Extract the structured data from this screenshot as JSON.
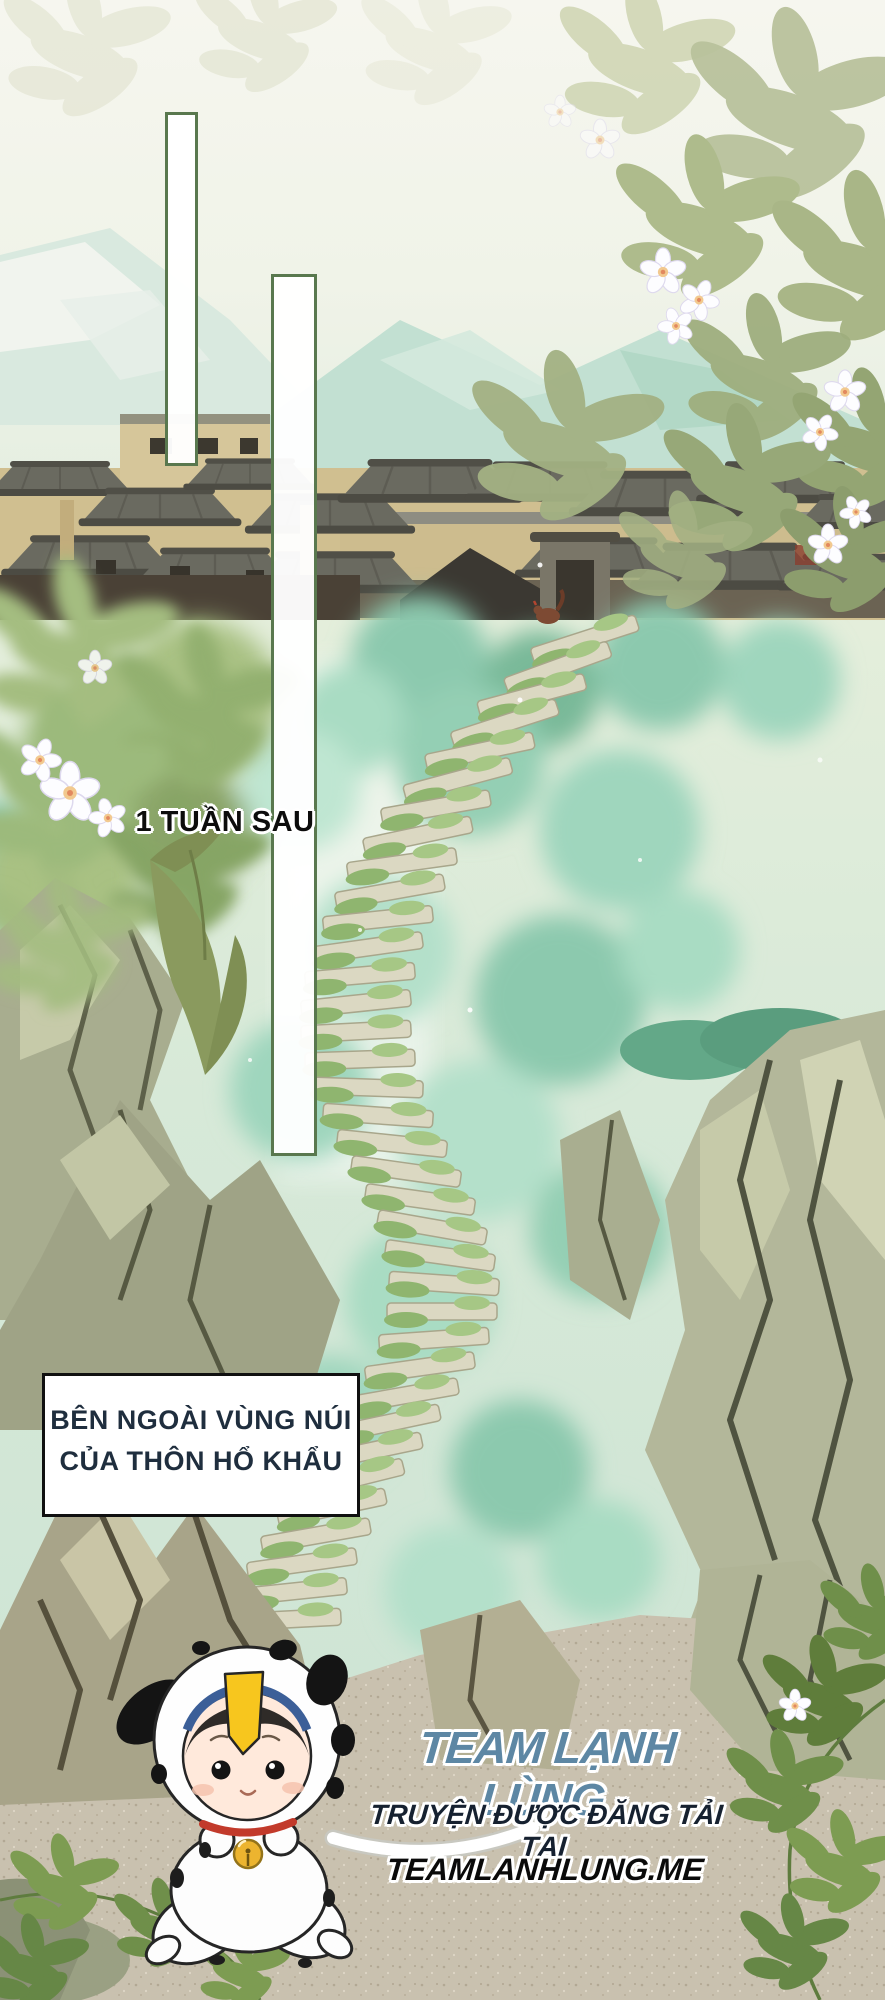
{
  "sfx": {
    "original": "一周后",
    "translation": "1 TUẦN SAU"
  },
  "caption": {
    "line1": "BÊN NGOÀI VÙNG NÚI",
    "line2": "CỦA THÔN HỔ KHẨU"
  },
  "credits": {
    "team": "TEAM LẠNH LÙNG",
    "tagline": "TRUYỆN ĐƯỢC ĐĂNG TẢI TẠI",
    "site": "TEAMLANHLUNG.ME"
  },
  "colors": {
    "panel_bar_border": "#59784e",
    "sfx_text": "#0a0a0a",
    "caption_text": "#1f2e3e",
    "team_text": "#5d87a4",
    "tagline_text": "#162130",
    "site_text": "#0a0a0a"
  }
}
